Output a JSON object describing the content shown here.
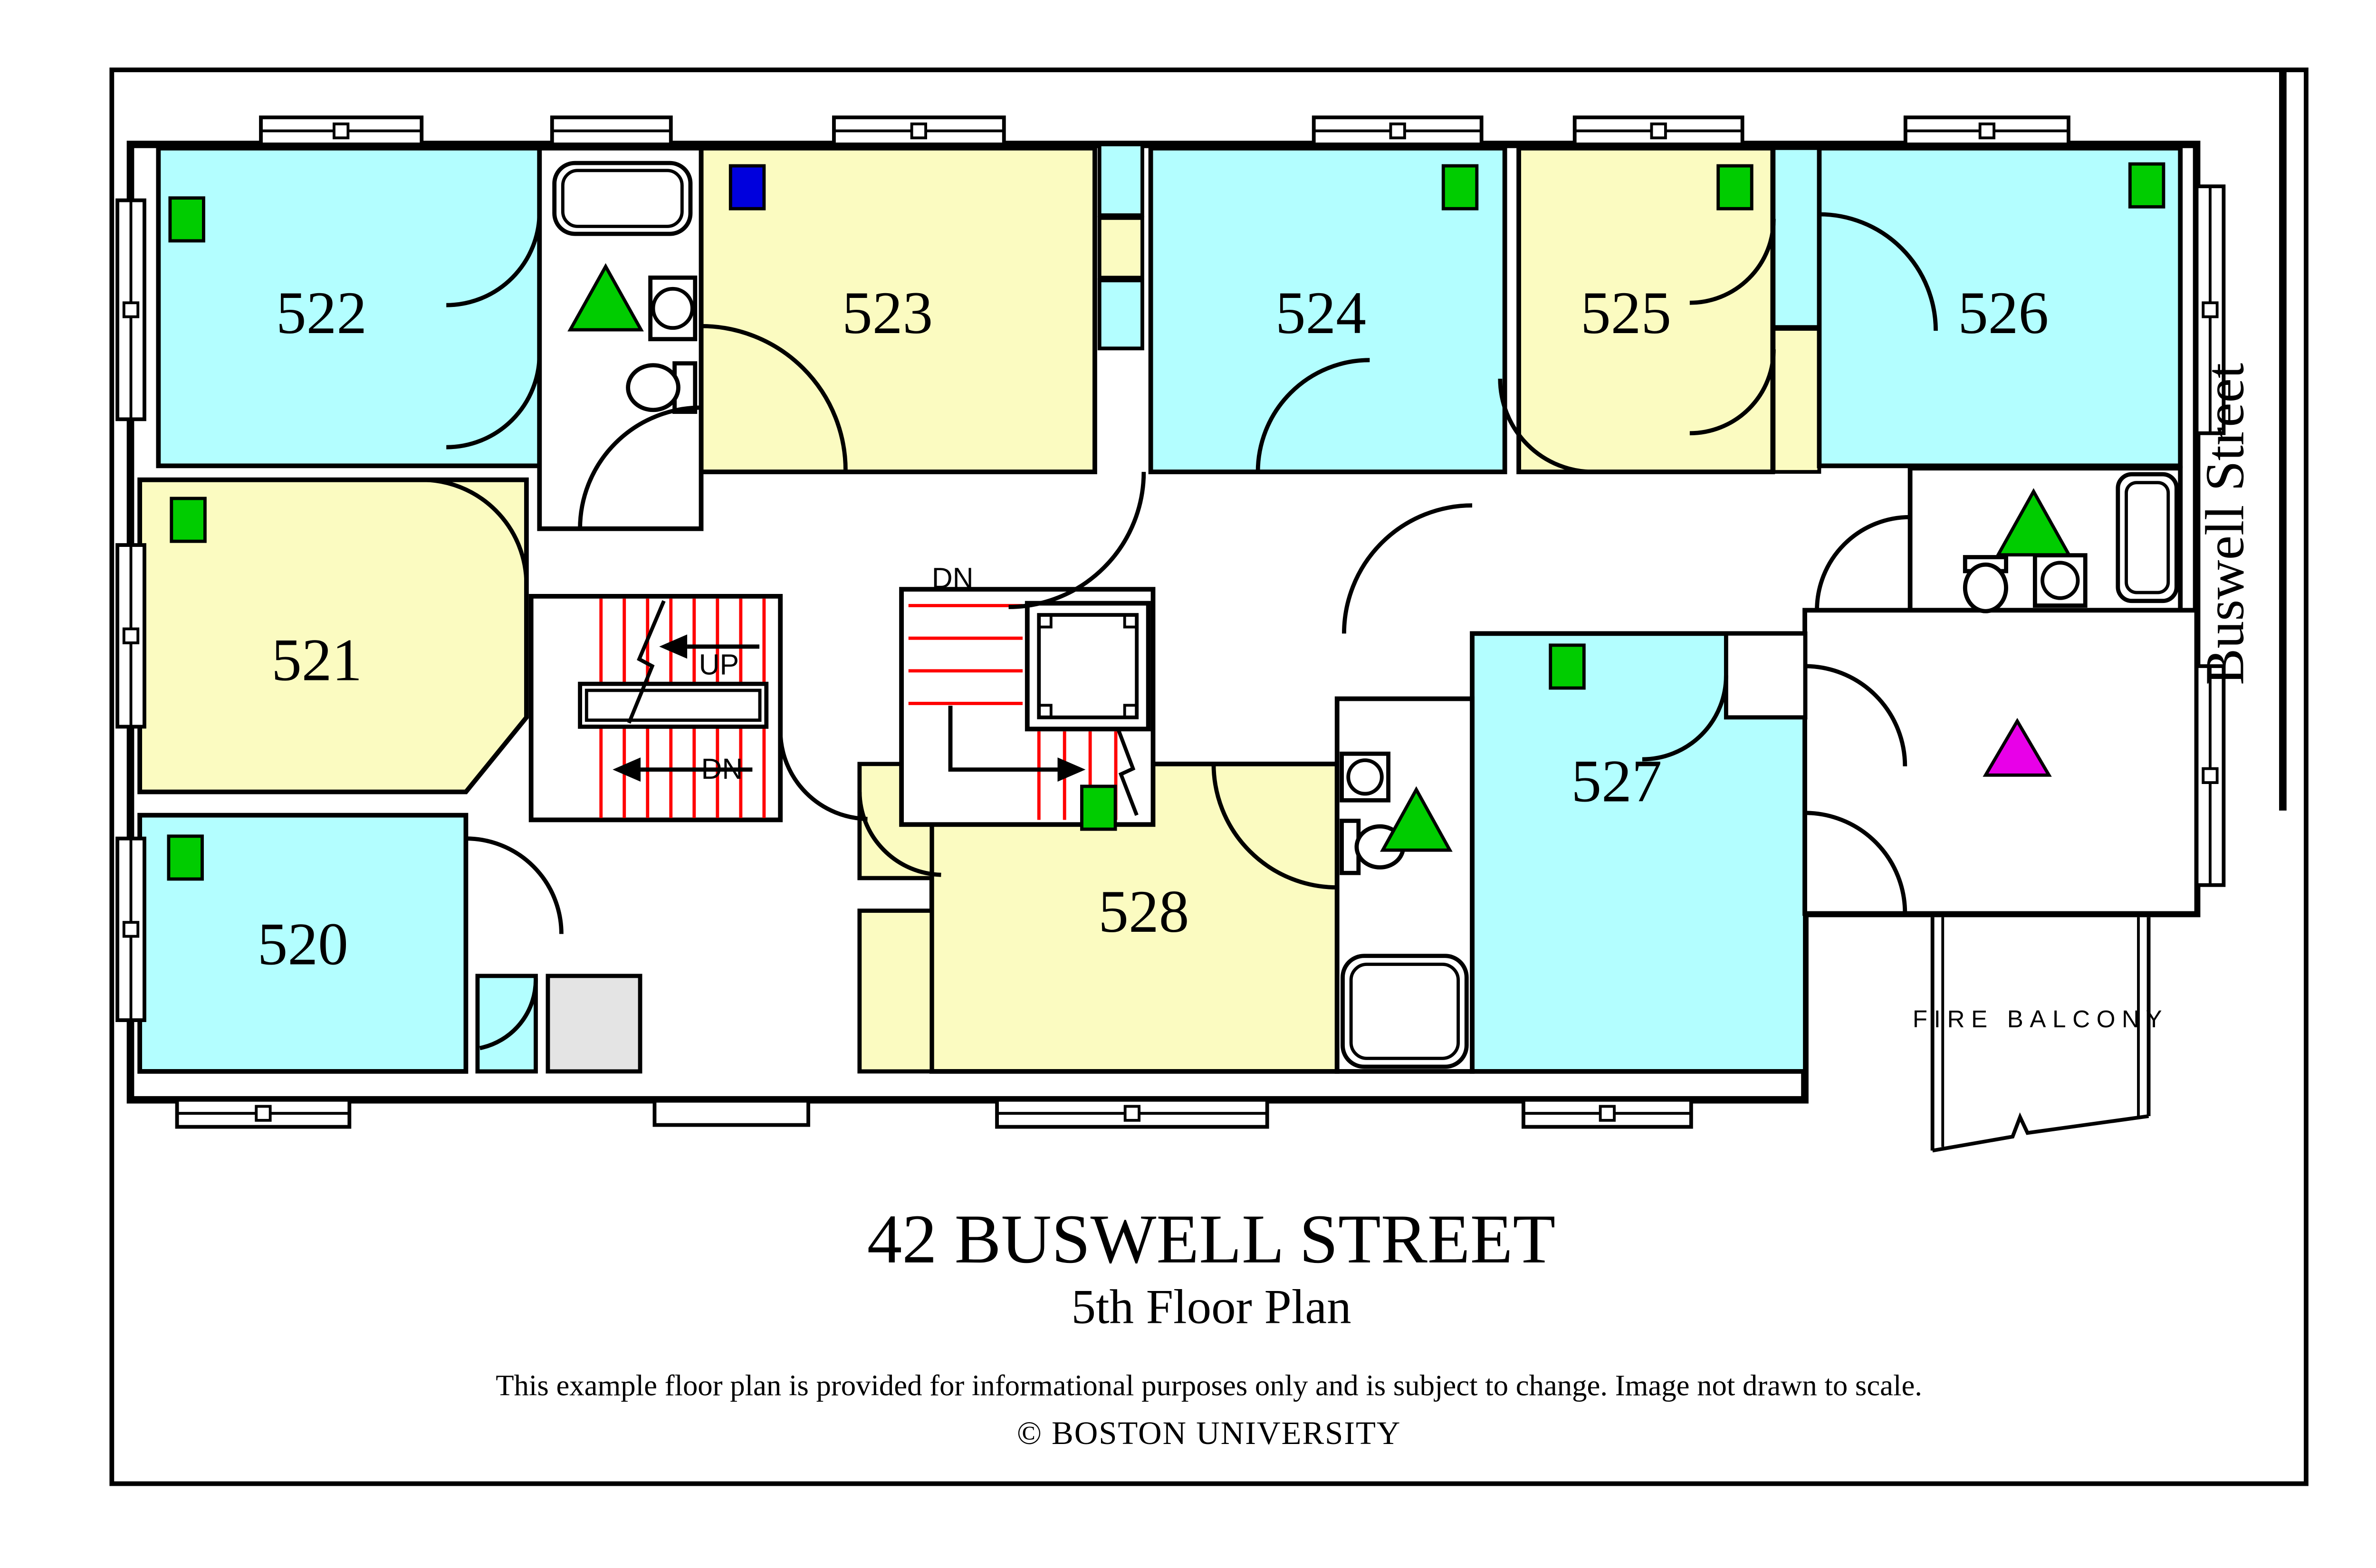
{
  "title": {
    "line1": "42 BUSWELL STREET",
    "line2": "5th Floor Plan"
  },
  "footer": {
    "disclaimer": "This example floor plan is provided for informational purposes only and is subject to change. Image not drawn to scale.",
    "copyright": "© BOSTON UNIVERSITY"
  },
  "street": {
    "label": "Buswell Street"
  },
  "balcony": {
    "label": "FIRE BALCONY"
  },
  "stairs": {
    "left_up": "UP",
    "left_dn": "DN",
    "center_dn": "DN"
  },
  "rooms": [
    {
      "number": "520",
      "color": "cyan"
    },
    {
      "number": "521",
      "color": "yellow"
    },
    {
      "number": "522",
      "color": "cyan"
    },
    {
      "number": "523",
      "color": "yellow"
    },
    {
      "number": "524",
      "color": "cyan"
    },
    {
      "number": "525",
      "color": "yellow"
    },
    {
      "number": "526",
      "color": "cyan"
    },
    {
      "number": "527",
      "color": "cyan"
    },
    {
      "number": "528",
      "color": "yellow"
    }
  ],
  "colors": {
    "room_cyan": "#B3FEFF",
    "room_yellow": "#FBFBC1",
    "icon_green": "#00CC00",
    "icon_blue": "#0000DD",
    "icon_magenta": "#E800E8",
    "stair_red": "#FF0000",
    "shaft_gray": "#E4E4E4",
    "line_black": "#000000"
  }
}
